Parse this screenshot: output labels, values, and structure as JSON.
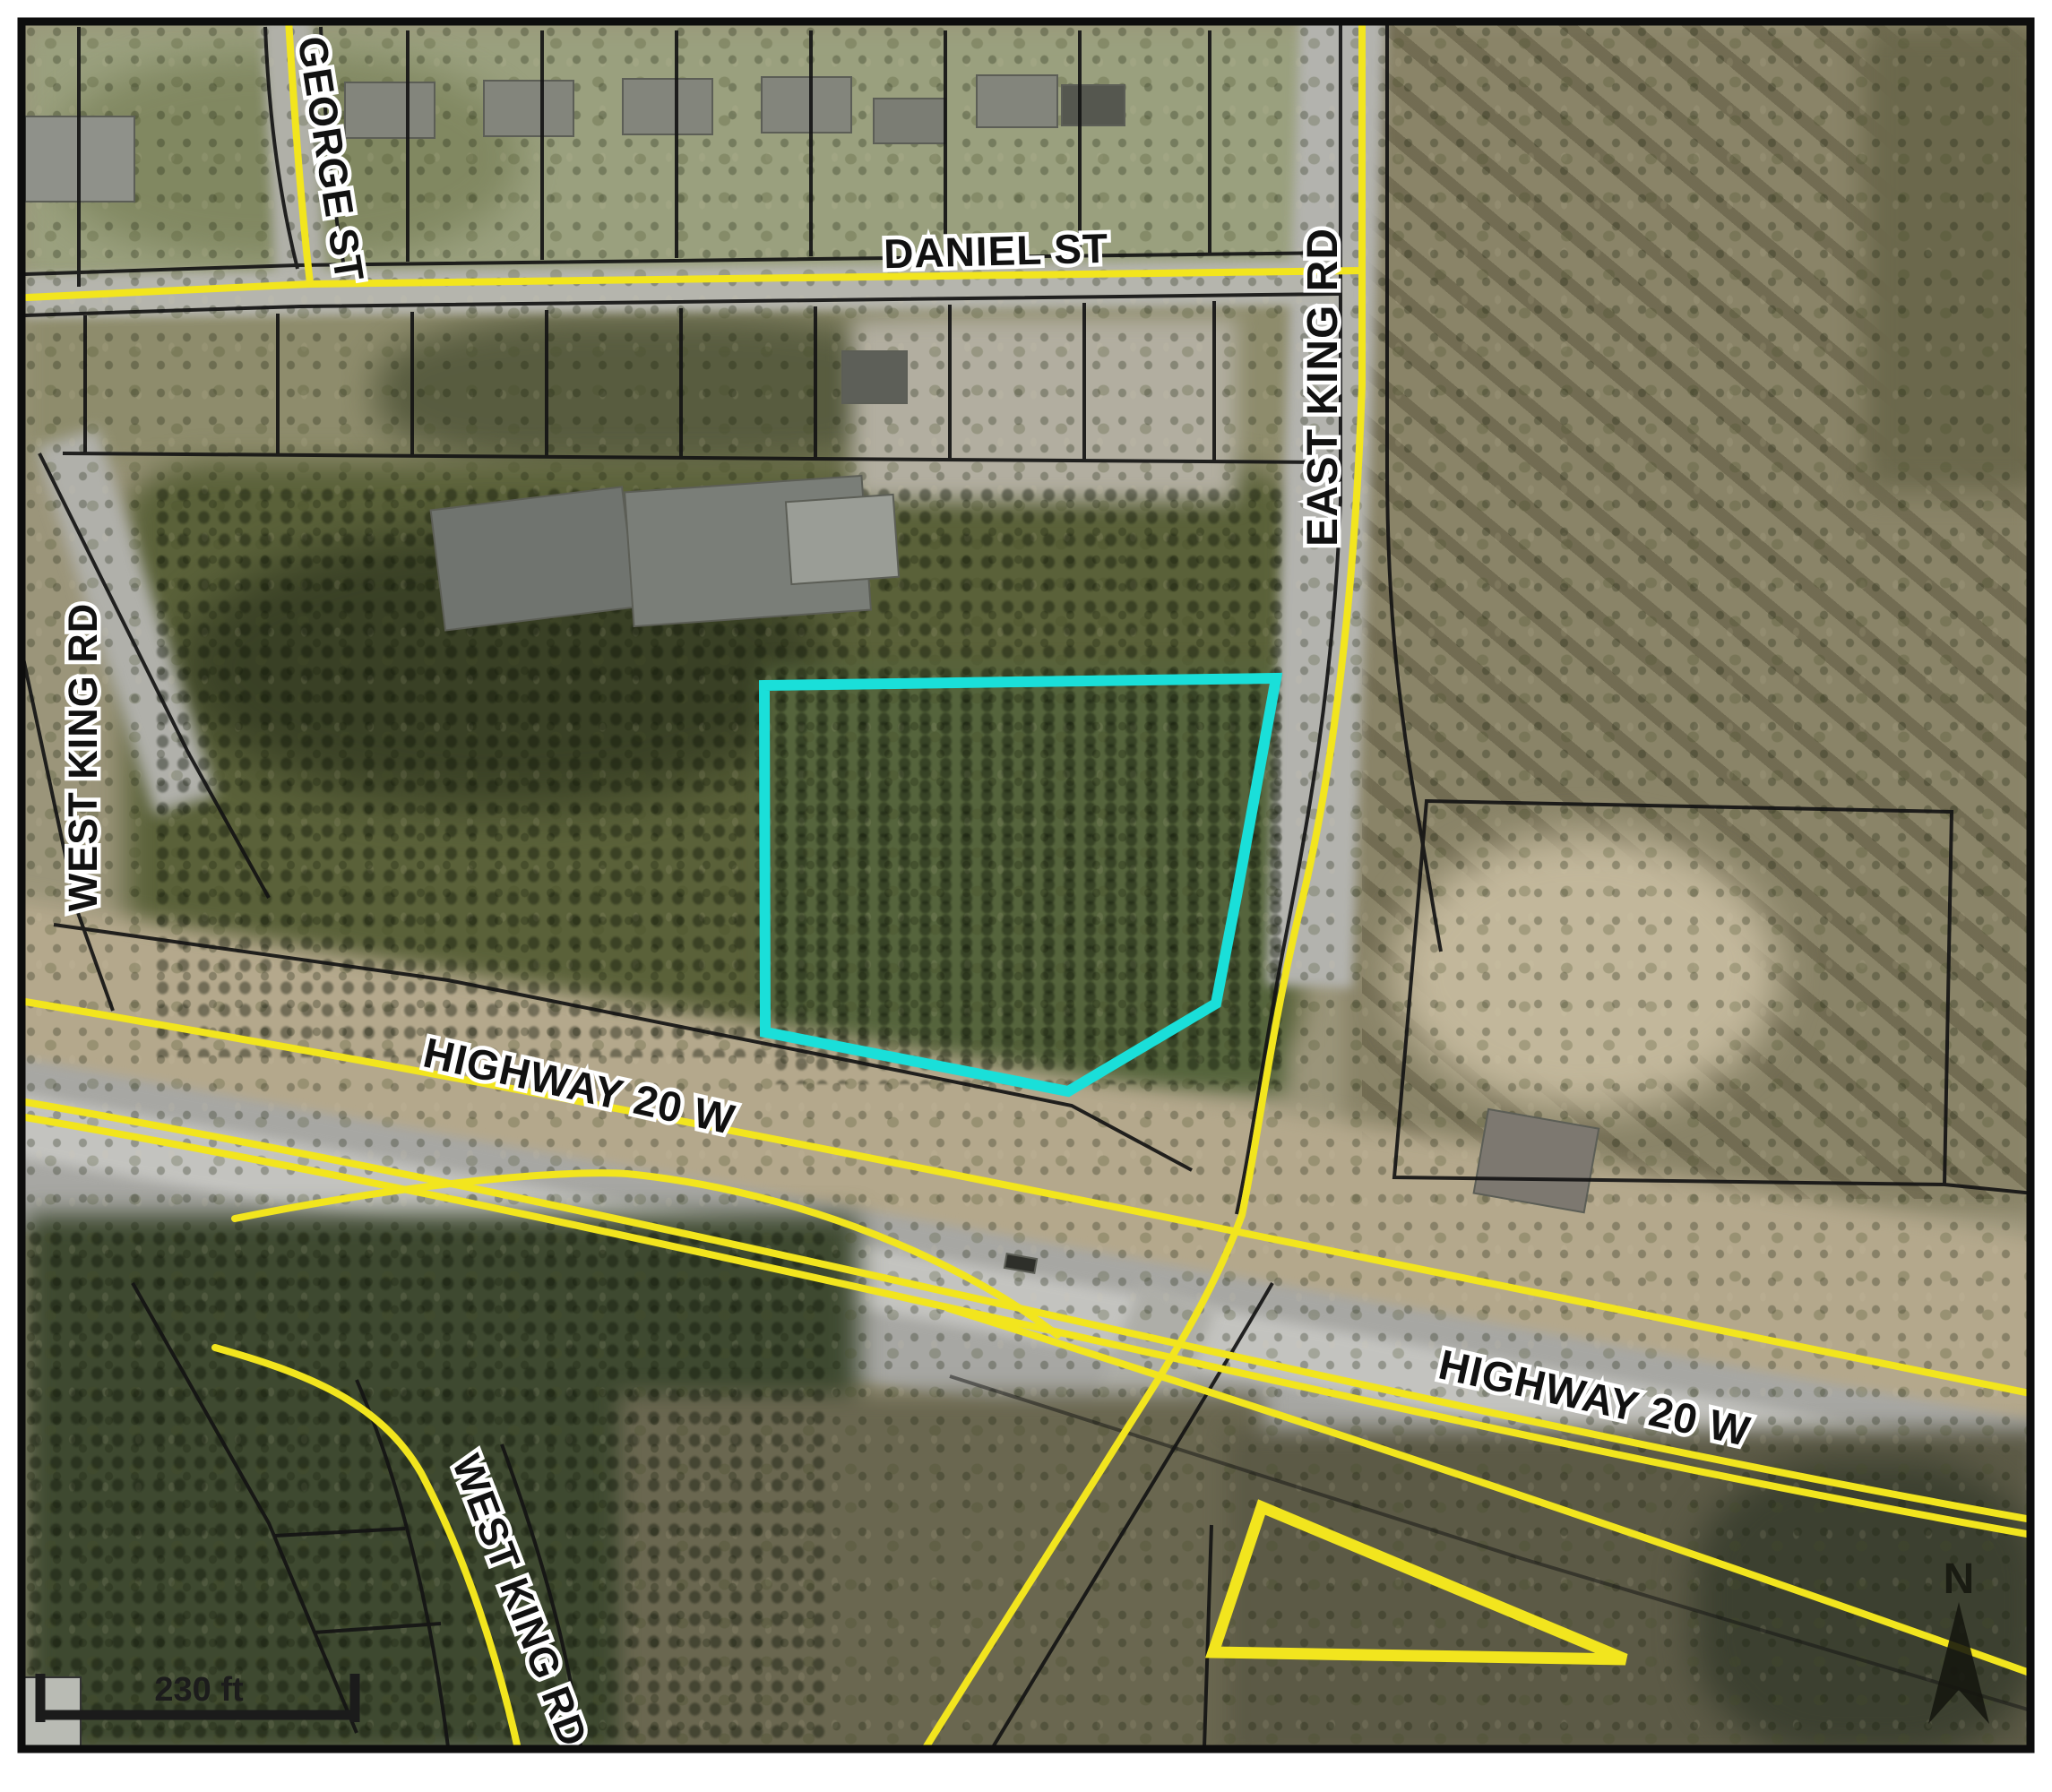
{
  "map": {
    "type": "aerial-parcel-map",
    "road_labels": {
      "george_st": "GEORGE ST",
      "daniel_st": "DANIEL ST",
      "east_king_rd": "EAST KING RD",
      "west_king_rd_left": "WEST KING RD",
      "highway_20_w_left": "HIGHWAY 20 W",
      "highway_20_w_right": "HIGHWAY 20 W",
      "west_king_rd_bottom": "WEST KING RD"
    },
    "scale_bar": {
      "label": "230 ft"
    },
    "north_arrow": {
      "label": "N"
    },
    "colors": {
      "road_centerline": "#f2e51e",
      "highlight_parcel": "#1adfd9",
      "highlight_triangle": "#f2e51e",
      "parcel_boundary": "#141414",
      "frame": "#0d0d0d"
    }
  }
}
